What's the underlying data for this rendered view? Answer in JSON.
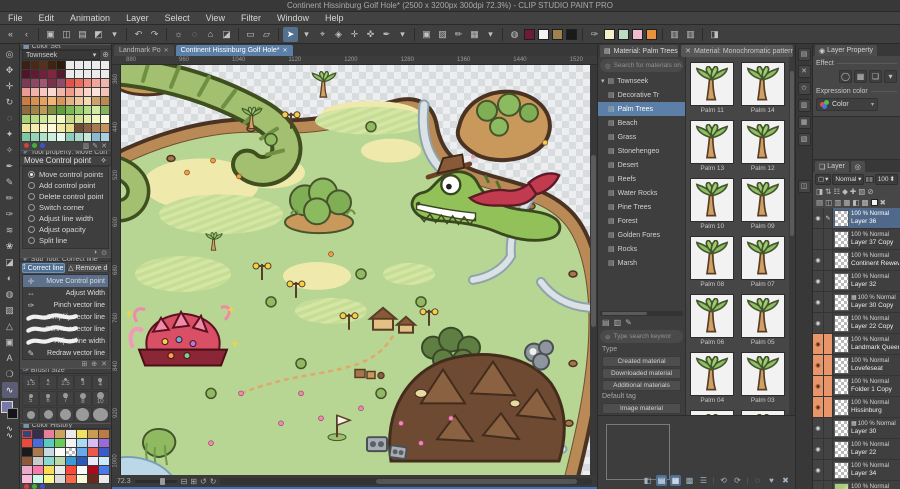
{
  "title_bar": {
    "title": "Continent Hissinburg Golf Hole* (2500 x 3200px 300dpi 72.3%)  - CLIP STUDIO PAINT PRO"
  },
  "menu": {
    "items": [
      "File",
      "Edit",
      "Animation",
      "Layer",
      "Select",
      "View",
      "Filter",
      "Window",
      "Help"
    ]
  },
  "toolbar": {
    "items": [
      {
        "t": "i",
        "g": "«",
        "n": "collapse-palette-left"
      },
      {
        "t": "i",
        "g": "‹",
        "n": "collapse-palette"
      },
      {
        "t": "s"
      },
      {
        "t": "i",
        "g": "▣",
        "n": "clip-studio-home"
      },
      {
        "t": "i",
        "g": "◫",
        "n": "new-canvas"
      },
      {
        "t": "i",
        "g": "▤",
        "n": "open-file"
      },
      {
        "t": "i",
        "g": "◩",
        "n": "save-file"
      },
      {
        "t": "i",
        "g": "▾",
        "n": "save-chevron"
      },
      {
        "t": "s"
      },
      {
        "t": "i",
        "g": "↶",
        "n": "undo"
      },
      {
        "t": "i",
        "g": "↷",
        "n": "redo"
      },
      {
        "t": "s"
      },
      {
        "t": "i",
        "g": "☼",
        "n": "clear"
      },
      {
        "t": "i",
        "g": "◌",
        "n": "deselect"
      },
      {
        "t": "i",
        "g": "⌂",
        "n": "crop"
      },
      {
        "t": "i",
        "g": "◪",
        "n": "fill"
      },
      {
        "t": "s"
      },
      {
        "t": "i",
        "g": "▭",
        "n": "snap-ruler"
      },
      {
        "t": "i",
        "g": "▱",
        "n": "snap-special"
      },
      {
        "t": "s"
      },
      {
        "t": "i",
        "g": "➤",
        "n": "object-tool",
        "active": true
      },
      {
        "t": "i",
        "g": "▾",
        "n": "object-tool-chevron"
      },
      {
        "t": "i",
        "g": "⌖",
        "n": "move-layer-tool"
      },
      {
        "t": "i",
        "g": "◈",
        "n": "wand-tool"
      },
      {
        "t": "i",
        "g": "✛",
        "n": "transform-tool"
      },
      {
        "t": "i",
        "g": "✜",
        "n": "anchor-tool"
      },
      {
        "t": "i",
        "g": "✒",
        "n": "pen-quick-tool"
      },
      {
        "t": "i",
        "g": "▾",
        "n": "pen-chevron"
      },
      {
        "t": "s"
      },
      {
        "t": "i",
        "g": "▣",
        "n": "panel-toggle"
      },
      {
        "t": "i",
        "g": "▨",
        "n": "image-panel"
      },
      {
        "t": "i",
        "g": "✏",
        "n": "brush-settings"
      },
      {
        "t": "i",
        "g": "▦",
        "n": "grid-toggle"
      },
      {
        "t": "i",
        "g": "▾",
        "n": "grid-chevron"
      },
      {
        "t": "s"
      },
      {
        "t": "i",
        "g": "◍",
        "n": "special-ruler"
      },
      {
        "t": "c",
        "v": "#6e1b38",
        "n": "swatch-maroon"
      },
      {
        "t": "c",
        "v": "#f2f2f2",
        "n": "swatch-white"
      },
      {
        "t": "c",
        "v": "#a08050",
        "n": "swatch-tan"
      },
      {
        "t": "c",
        "v": "#1a1a1a",
        "n": "swatch-black"
      },
      {
        "t": "s"
      },
      {
        "t": "i",
        "g": "✑",
        "n": "eyedropper"
      },
      {
        "t": "c",
        "v": "#f4f0c8",
        "n": "swatch-cream"
      },
      {
        "t": "c",
        "v": "#bcdcc4",
        "n": "swatch-mint"
      },
      {
        "t": "c",
        "v": "#f2bcd0",
        "n": "swatch-pink"
      },
      {
        "t": "c",
        "v": "#e8923e",
        "n": "swatch-orange"
      },
      {
        "t": "s"
      },
      {
        "t": "i",
        "g": "▥",
        "n": "material-shortcut-1"
      },
      {
        "t": "i",
        "g": "▥",
        "n": "material-shortcut-2"
      },
      {
        "t": "s"
      },
      {
        "t": "i",
        "g": "◨",
        "n": "workspace-toggle"
      }
    ]
  },
  "toolstrip": {
    "items": [
      {
        "g": "◎",
        "n": "zoom-tool"
      },
      {
        "g": "✥",
        "n": "hand-tool"
      },
      {
        "g": "✛",
        "n": "move-tool"
      },
      {
        "g": "↻",
        "n": "rotate-tool"
      },
      {
        "g": "◌",
        "n": "selection-tool"
      },
      {
        "g": "✦",
        "n": "lasso-tool"
      },
      {
        "g": "✧",
        "n": "auto-select-tool"
      },
      {
        "g": "✒",
        "n": "eyedropper-tool"
      },
      {
        "g": "✎",
        "n": "pen-tool"
      },
      {
        "g": "✏",
        "n": "pencil-tool"
      },
      {
        "g": "✑",
        "n": "brush-tool"
      },
      {
        "g": "≋",
        "n": "airbrush-tool"
      },
      {
        "g": "❀",
        "n": "decoration-tool"
      },
      {
        "g": "◪",
        "n": "eraser-tool"
      },
      {
        "g": "◐",
        "n": "blend-tool"
      },
      {
        "g": "◍",
        "n": "fill-tool"
      },
      {
        "g": "▨",
        "n": "gradient-tool"
      },
      {
        "g": "△",
        "n": "figure-tool"
      },
      {
        "g": "▣",
        "n": "frame-border-tool"
      },
      {
        "g": "A",
        "n": "text-tool"
      },
      {
        "g": "❍",
        "n": "balloon-tool"
      },
      {
        "g": "∿",
        "n": "line-correct-tool",
        "active": true
      }
    ],
    "fg_color": "#7878aa",
    "bg_color": "#14141a"
  },
  "canvas": {
    "tabs": [
      {
        "label": "Landmark Po",
        "active": false
      },
      {
        "label": "Continent Hissinburg Golf Hole*",
        "active": true
      }
    ],
    "h_ruler": [
      "880",
      "960",
      "1040",
      "1120",
      "1200",
      "1280",
      "1360",
      "1440",
      "1520"
    ],
    "v_ruler": [
      "360",
      "440",
      "520",
      "600",
      "680",
      "760",
      "840",
      "920",
      "1000"
    ],
    "zoom_value": "72.3",
    "bottom_icons": [
      "⊟",
      "⊞",
      "↺",
      "↻"
    ]
  },
  "left_panel": {
    "color_set": {
      "tab": "Color Set",
      "preset": "Townseek",
      "swatches": [
        "#3a2113",
        "#4a2917",
        "#563019",
        "#3f2410",
        "#2c1a0c",
        "#ebebeb",
        "#ebebeb",
        "#ebebeb",
        "#ebebeb",
        "#ebebeb",
        "#4e1628",
        "#601b33",
        "#72213d",
        "#82263f",
        "#561a2c",
        "#ebebeb",
        "#ebebeb",
        "#ebebeb",
        "#ebebeb",
        "#ebebeb",
        "#7a3c54",
        "#8e4862",
        "#a25670",
        "#7c3048",
        "#8e4a66",
        "#e25248",
        "#ee6a58",
        "#f18a80",
        "#f4a49a",
        "#f0b6ae",
        "#ea9c94",
        "#f1b2aa",
        "#f6c8c0",
        "#f8dad2",
        "#f2b6a8",
        "#ef9c8a",
        "#f7c2b2",
        "#fad6c8",
        "#f8e4d8",
        "#f2c4b8",
        "#ca7c42",
        "#da8e50",
        "#e8a260",
        "#f0b676",
        "#d9945a",
        "#e8b288",
        "#f0c69c",
        "#f6dab4",
        "#cca26a",
        "#ba8a50",
        "#8c6c40",
        "#a2844a",
        "#ba9c58",
        "#808e44",
        "#619e3e",
        "#7db857",
        "#99ce70",
        "#b6de8a",
        "#d2eaa6",
        "#88b25e",
        "#a6ce72",
        "#bada84",
        "#cee89a",
        "#e2f2b0",
        "#f0f8c6",
        "#c6d886",
        "#d6e498",
        "#e6f0ae",
        "#f2f8c4",
        "#fafbd8",
        "#eee49c",
        "#f4ecb0",
        "#faf4c6",
        "#fdf9da",
        "#f1e8a4",
        "#e8db8e",
        "#704c34",
        "#8c6142",
        "#a87a50",
        "#c49360",
        "#7ec6a2",
        "#96d4b6",
        "#b0e2ca",
        "#caeedc",
        "#e2f8ec",
        "#8ecbba",
        "#aadaca",
        "#c6e8da",
        "#8abad2",
        "#aacede"
      ]
    },
    "tool_property": {
      "header": "Tool property: Move Con",
      "tool_name": "Move Control point",
      "options": [
        {
          "label": "Move control points",
          "selected": true
        },
        {
          "label": "Add control point"
        },
        {
          "label": "Delete control point"
        },
        {
          "label": "Switch corner"
        },
        {
          "label": "Adjust line width"
        },
        {
          "label": "Adjust opacity"
        },
        {
          "label": "Split line"
        }
      ]
    },
    "sub_tool": {
      "header": "Sub Tool: Correct line",
      "buttons": [
        {
          "label": "Correct line",
          "on": true
        },
        {
          "label": "Remove d",
          "on": false
        }
      ],
      "items": [
        {
          "label": "Move Control point",
          "glyph": "✛",
          "selected": true
        },
        {
          "label": "Adjust Width",
          "glyph": "⇔"
        },
        {
          "label": "Pinch vector line",
          "glyph": "✑"
        },
        {
          "label": "Simplify vector line",
          "glyph": "",
          "wavy": true
        },
        {
          "label": "Connect vector line",
          "glyph": "",
          "wavy": true
        },
        {
          "label": "Adjust line width",
          "glyph": "",
          "wavy": true
        },
        {
          "label": "Redraw vector line",
          "glyph": "✎"
        }
      ]
    },
    "brush_size": {
      "tab": "Brush Size",
      "rows": [
        {
          "labels": [
            "1.5",
            "2",
            "2.5",
            "3",
            "4"
          ],
          "dots": [
            2,
            2,
            3,
            3,
            4
          ]
        },
        {
          "labels": [
            "5",
            "6",
            "7",
            "8",
            "10"
          ],
          "dots": [
            4,
            4,
            5,
            6,
            7
          ]
        },
        {
          "labels": [
            "",
            "",
            "",
            "",
            ""
          ],
          "dots": [
            8,
            9,
            11,
            13,
            15
          ]
        }
      ]
    },
    "color_history": {
      "tab": "Color History",
      "selected_index": 0,
      "swatches": [
        "#2c4a78",
        "#3c2c4c",
        "#ea7c9c",
        "#caa262",
        "#eaeaea",
        "#f2e262",
        "#ca9c52",
        "#ba7c42",
        "#ea4a3c",
        "#4c6ada",
        "#5acac2",
        "#6aca5a",
        "#f2f2f2",
        "#aadaf2",
        "#dabaf2",
        "#9a6ada",
        "#1a1a1a",
        "#aa7a4a",
        "#cadae2",
        "#fafafa",
        "checker",
        "#6aaaea",
        "#ea5a4a",
        "#3a5aca",
        "#8c5a3a",
        "#cacaca",
        "#8adad2",
        "#badaaa",
        "#3a9ada",
        "#2a5aba",
        "#eaeafa",
        "#caeafa",
        "#eaaaca",
        "#fa7aaa",
        "#fada5a",
        "#eaeaea",
        "#fa4a3a",
        "#fafafa",
        "#aa0a1a",
        "#4a7aea",
        "#fabada",
        "#cafae8",
        "#fafa8a",
        "#dadada",
        "#fa6a4a",
        "#fafada",
        "#6a2a1a",
        "#eaeaea"
      ]
    }
  },
  "material": {
    "tab": "Material: Palm Trees",
    "floating_tab": "Material: Monochromatic pattern",
    "search_top": "Search for materials on AS",
    "tree": {
      "root": "Townseek",
      "selected": "Palm Trees",
      "items": [
        "Decorative Tr",
        "Palm Trees",
        "Beach",
        "Grass",
        "Stonehengeo",
        "Desert",
        "Reefs",
        "Water Rocks",
        "Pine Trees",
        "Forest",
        "Golden  Fores",
        "Rocks",
        "Marsh"
      ]
    },
    "search_bottom": "Type search keywor",
    "type_label": "Type",
    "type_buttons": [
      "Created material",
      "Downloaded material",
      "Additional materials"
    ],
    "default_tag_label": "Default tag",
    "tag_buttons": [
      "Image material"
    ],
    "thumbnails": [
      "Palm 11",
      "Palm 14",
      "Palm 13",
      "Palm 12",
      "Palm 10",
      "Palm 09",
      "Palm 08",
      "Palm 07",
      "Palm 06",
      "Palm 05",
      "Palm 04",
      "Palm 03",
      "",
      ""
    ],
    "footer_icons": [
      {
        "g": "◧"
      },
      {
        "g": "▤",
        "hl": true
      },
      {
        "g": "▦",
        "hl": true
      },
      {
        "g": "▩"
      },
      {
        "g": "☰"
      },
      {
        "g": "|",
        "sep": true
      },
      {
        "g": "⟲"
      },
      {
        "g": "⟳"
      },
      {
        "g": "|",
        "sep": true
      },
      {
        "g": "◌"
      },
      {
        "g": "♥"
      },
      {
        "g": "✖"
      }
    ]
  },
  "dock": {
    "icons": [
      "▤",
      "✕",
      "✩",
      "▥",
      "▦",
      "▧"
    ],
    "lower_icon": "◫"
  },
  "layer_property": {
    "tab": "Layer Property",
    "effect_label": "Effect",
    "effect_icons": [
      "◯",
      "▦",
      "❏",
      "▾"
    ],
    "expression_label": "Expression color",
    "expression_value": "Color",
    "chevron": "▾"
  },
  "layer_panel": {
    "tab": "Layer",
    "blend_mode": "Normal",
    "opacity": "100",
    "ctl_icons_row2": [
      "◨",
      "⇅",
      "☷",
      "◆",
      "✚",
      "▨",
      "⊘"
    ],
    "ctl_icons_row3": [
      "▤",
      "◫",
      "▥",
      "▦",
      "◧",
      "▩",
      "□",
      "✖"
    ],
    "layers": [
      {
        "info": "100 % Normal",
        "name": "Layer 36",
        "eye": true,
        "pen": true,
        "selected": true
      },
      {
        "info": "100 % Normal",
        "name": "Layer 37 Copy",
        "eye": false
      },
      {
        "info": "100 % Normal",
        "name": "Continent Rewewsilv",
        "eye": true
      },
      {
        "info": "100 % Normal",
        "name": "Layer 32",
        "eye": true
      },
      {
        "info": "100 % Normal",
        "name": "Layer 30 Copy",
        "eye": true,
        "tone": true
      },
      {
        "info": "100 % Normal",
        "name": "Layer 22 Copy",
        "eye": true
      },
      {
        "info": "100 % Normal",
        "name": "Landmark Queen Naru",
        "eye": true,
        "orange": true
      },
      {
        "info": "100 % Normal",
        "name": "Lovefeseat",
        "eye": true,
        "orange": true
      },
      {
        "info": "100 % Normal",
        "name": "Folder 1 Copy",
        "eye": true,
        "orange": true
      },
      {
        "info": "100 % Normal",
        "name": "Hissinburg",
        "eye": true,
        "orange": true
      },
      {
        "info": "100 % Normal",
        "name": "Layer 30",
        "eye": true,
        "tone": true
      },
      {
        "info": "100 % Normal",
        "name": "Layer 22",
        "eye": true
      },
      {
        "info": "100 % Normal",
        "name": "Layer 34",
        "eye": true
      },
      {
        "info": "100 % Normal",
        "name": "Continent Base Co",
        "eye": true,
        "green": true
      }
    ]
  },
  "colors": {
    "accent": "#5b7fa6",
    "selection_orange": "#e8956a",
    "land_green": "#b7d694",
    "coast_tan": "#b98a55"
  }
}
